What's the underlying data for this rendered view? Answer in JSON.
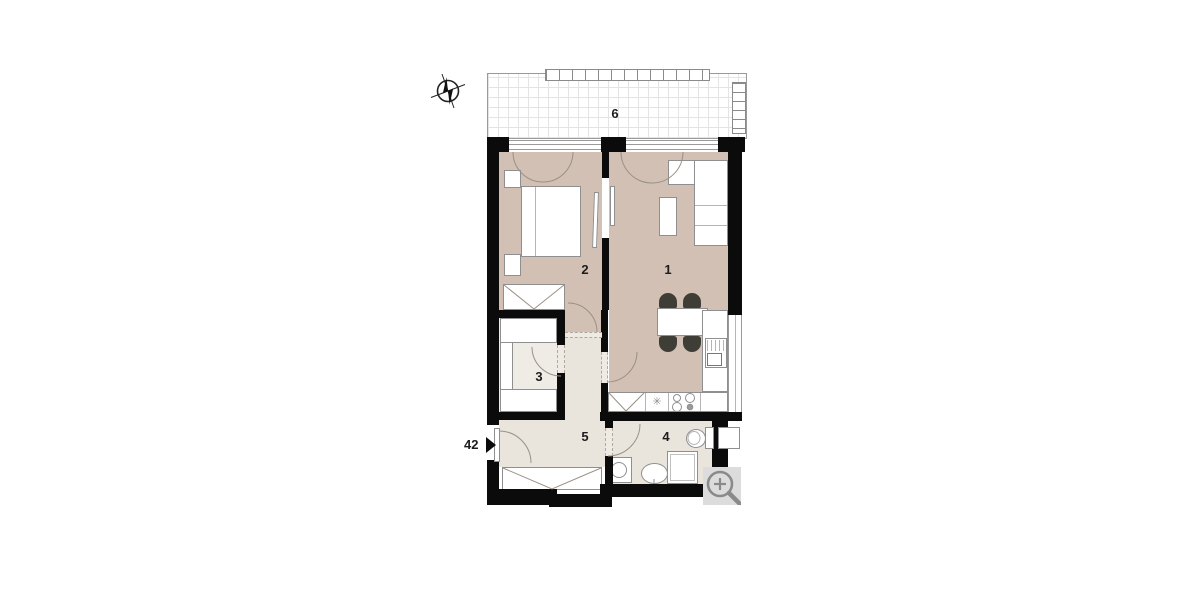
{
  "plan": {
    "title": "apartment-floor-plan",
    "rooms": [
      {
        "id": "living-room",
        "label": "1"
      },
      {
        "id": "bedroom",
        "label": "2"
      },
      {
        "id": "storage",
        "label": "3"
      },
      {
        "id": "bathroom",
        "label": "4"
      },
      {
        "id": "hallway",
        "label": "5"
      },
      {
        "id": "terrace",
        "label": "6"
      }
    ],
    "entrance": {
      "number": "42"
    },
    "kitchen": {
      "dishwasher_symbol": "✳"
    },
    "colors": {
      "wall": "#0b0b0b",
      "warm_floor": "#d2c0b4",
      "light_floor": "#e9e4dc",
      "pale_floor": "#efece6",
      "furniture_outline": "#8f8f8f",
      "magnifier_bg": "#dcdcdc",
      "magnifier_fg": "#8a8a8a"
    }
  }
}
